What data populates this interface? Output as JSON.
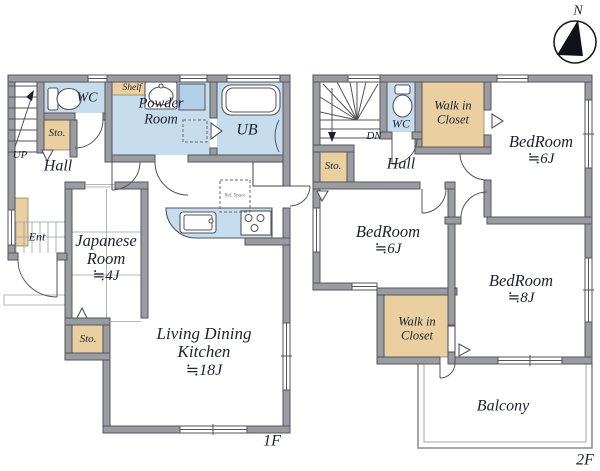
{
  "colors": {
    "wall": "#9b9ba2",
    "outline": "#54545c",
    "wet": "#c7ddee",
    "tan": "#eacfa0",
    "text": "#1d2130"
  },
  "compass": {
    "north_label": "N"
  },
  "floor1": {
    "floor_label": "1F",
    "stairs_direction": "UP",
    "hall": "Hall",
    "wc": "WC",
    "storage_upper": "Sto.",
    "shelf": "Shelf",
    "powder_room": "Powder Room",
    "unit_bath": "UB",
    "entrance": "Ent",
    "japanese_room": {
      "name": "Japanese Room",
      "size": "≒4J"
    },
    "living_dining_kitchen": {
      "name": "Living Dining Kitchen",
      "size": "≒18J"
    },
    "storage_lower": "Sto.",
    "fridge_note": "Ref. Space"
  },
  "floor2": {
    "floor_label": "2F",
    "stairs_direction": "DN",
    "hall": "Hall",
    "wc": "WC",
    "storage": "Sto.",
    "walkin_closet_upper": "Walk in Closet",
    "walkin_closet_lower": "Walk in Closet",
    "bedroom_northeast": {
      "name": "BedRoom",
      "size": "≒6J"
    },
    "bedroom_west": {
      "name": "BedRoom",
      "size": "≒6J"
    },
    "bedroom_southeast": {
      "name": "BedRoom",
      "size": "≒8J"
    },
    "balcony": "Balcony"
  }
}
